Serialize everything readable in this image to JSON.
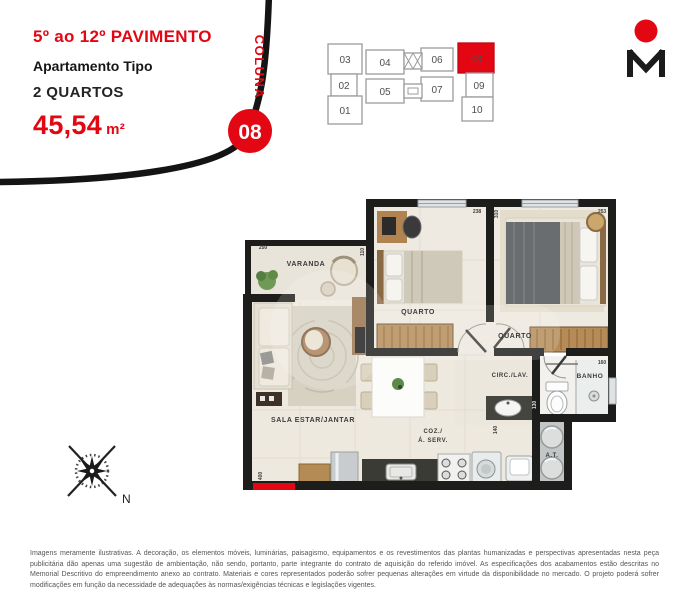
{
  "header": {
    "floors": "5º ao 12º PAVIMENTO",
    "apartment_type": "Apartamento Tipo",
    "bedrooms": "2 QUARTOS",
    "area_value": "45,54",
    "area_unit": "m²",
    "column_label": "COLUNA",
    "unit_number": "08"
  },
  "key_plan": {
    "highlighted_unit": "08",
    "units": [
      {
        "id": "01"
      },
      {
        "id": "02"
      },
      {
        "id": "03"
      },
      {
        "id": "04"
      },
      {
        "id": "05"
      },
      {
        "id": "06"
      },
      {
        "id": "07"
      },
      {
        "id": "08"
      },
      {
        "id": "09"
      },
      {
        "id": "10"
      }
    ]
  },
  "floor_plan": {
    "rooms": {
      "varanda": "VARANDA",
      "quarto1": "QUARTO",
      "quarto2": "QUARTO",
      "sala": "SALA ESTAR/JANTAR",
      "circ": "CIRC./LAV.",
      "banho": "BANHO",
      "coz_line1": "COZ./",
      "coz_line2": "Á. SERV.",
      "area_tecnica": "A.T."
    },
    "dims": {
      "varanda_width": "250",
      "varanda_side": "110",
      "quarto1_width": "238",
      "divider_depth": "310",
      "quarto2_width": "253",
      "banho_width": "160",
      "banho_depth": "130",
      "circ_depth": "140",
      "sala_depth": "400"
    }
  },
  "compass": {
    "north": "N"
  },
  "brand": {
    "monogram": "M"
  },
  "colors": {
    "accent": "#e30613",
    "wall": "#1d1d1b"
  },
  "disclaimer": "Imagens meramente ilustrativas. A decoração, os elementos móveis, luminárias, paisagismo, equipamentos e os revestimentos das plantas humanizadas e perspectivas apresentadas nesta peça publicitária dão apenas uma sugestão de ambientação, não sendo, portanto, parte integrante do contrato de aquisição do referido imóvel. As especificações dos acabamentos estão descritas no Memorial Descritivo do empreendimento anexo ao contrato. Materiais e cores representados poderão sofrer pequenas alterações em virtude da disponibilidade no mercado. O projeto poderá sofrer modificações em função da necessidade de adequações às normas/exigências técnicas e legislações vigentes."
}
